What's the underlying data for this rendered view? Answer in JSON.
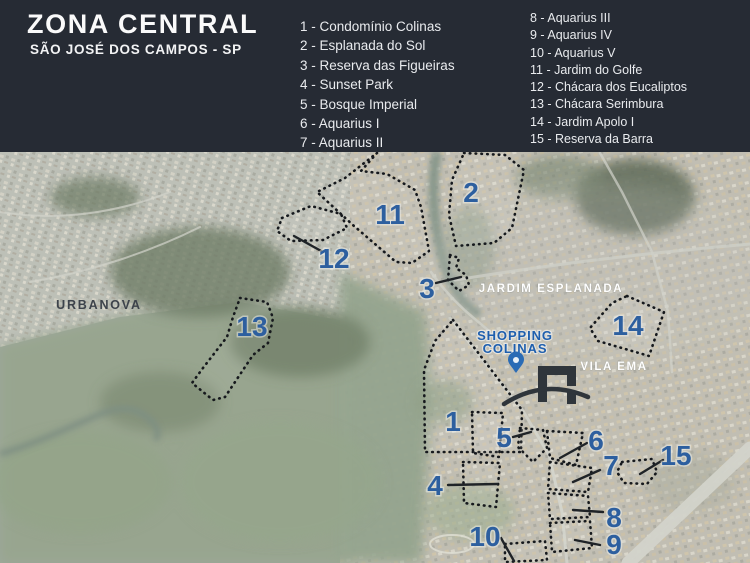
{
  "header": {
    "title": "ZONA CENTRAL",
    "subtitle": "SÃO JOSÉ DOS CAMPOS - SP",
    "legend_col1": [
      "1 - Condomínio Colinas",
      "2 - Esplanada do Sol",
      "3 - Reserva das Figueiras",
      "4 - Sunset Park",
      "5 - Bosque Imperial",
      "6 - Aquarius I",
      "7 - Aquarius II"
    ],
    "legend_col2": [
      "8 - Aquarius III",
      "9 - Aquarius IV",
      "10 - Aquarius V",
      "11 - Jardim do Golfe",
      "12 - Chácara dos Eucaliptos",
      "13 - Chácara Serimbura",
      "14 - Jardim Apolo I",
      "15 - Reserva da Barra"
    ]
  },
  "map": {
    "labels": {
      "urbanova": "URBANOVA",
      "jardim_esplanada": "JARDIM ESPLANADA",
      "vila_ema": "VILA EMA"
    },
    "poi": {
      "shopping_line1": "SHOPPING",
      "shopping_line2": "COLINAS",
      "pin_icon": "map-pin-icon",
      "monument_icon": "arch-monument-icon"
    },
    "regions": {
      "n1": "1",
      "n2": "2",
      "n3": "3",
      "n4": "4",
      "n5": "5",
      "n6": "6",
      "n7": "7",
      "n8": "8",
      "n9": "9",
      "n10": "10",
      "n11": "11",
      "n12": "12",
      "n13": "13",
      "n14": "14",
      "n15": "15"
    },
    "colors": {
      "header_bg": "#262B34",
      "number_blue": "#2D5F9F",
      "shopping_blue": "#1E5FAE",
      "outline_dark": "#16191D",
      "label_dark": "#3D434B",
      "label_light": "#FFFFFF"
    }
  }
}
